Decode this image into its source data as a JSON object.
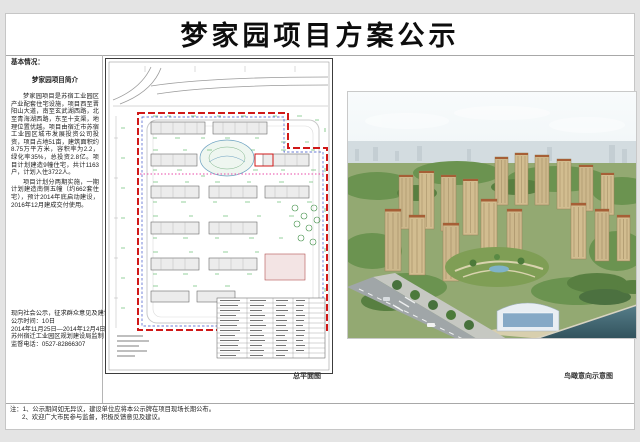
{
  "page": {
    "title": "梦家园项目方案公示"
  },
  "left_panel": {
    "heading": "基本情况：",
    "intro_title": "梦家园项目简介",
    "paragraph1": "梦家园项目是苏宿工业园区产业配套住宅设施，项目西至晋阳山大道，南至玄武湖西路，北至青海湖西路，东至十支渠，地理位置优越。项目由宿迁市苏宿工业园区城市发展投资公司投资，项目占地51亩，建筑面积约8.75万平方米，容积率为2.2，绿化率35%，总投资2.8亿。项目计划建造9幢住宅，共计1163户，计划入住3722人。",
    "paragraph2": "项目计划分两期实施，一期计划建造南侧五幢（约662套住宅），预计2014年底启动建设，2016年12月建成交付使用。",
    "notice_lines": [
      "现向社会公示，征求群众意见及建议，",
      "公示时间：10日",
      "2014年11月25日—2014年12月4日",
      "苏州宿迁工业园区规划建设局监制",
      "监督电话：0527-82866307"
    ]
  },
  "site_plan": {
    "caption": "总平面图"
  },
  "rendering": {
    "caption": "鸟瞰意向示意图"
  },
  "footer": {
    "lines": [
      "注：1、公示期间如无异议，建设单位应将本公示牌在项目现场长期公布。",
      "2、欢迎广大市民参与监督，积极反馈意见及建议。"
    ]
  },
  "colors": {
    "boundary_red": "#d01818",
    "boundary_blue": "#3a50c8",
    "annotation_green": "#2fa23a",
    "phase_line_pink": "#e84aa8",
    "building_tan": "#cdb88c",
    "water_teal": "#3a6270",
    "divider_gray": "#a8a8a8"
  }
}
